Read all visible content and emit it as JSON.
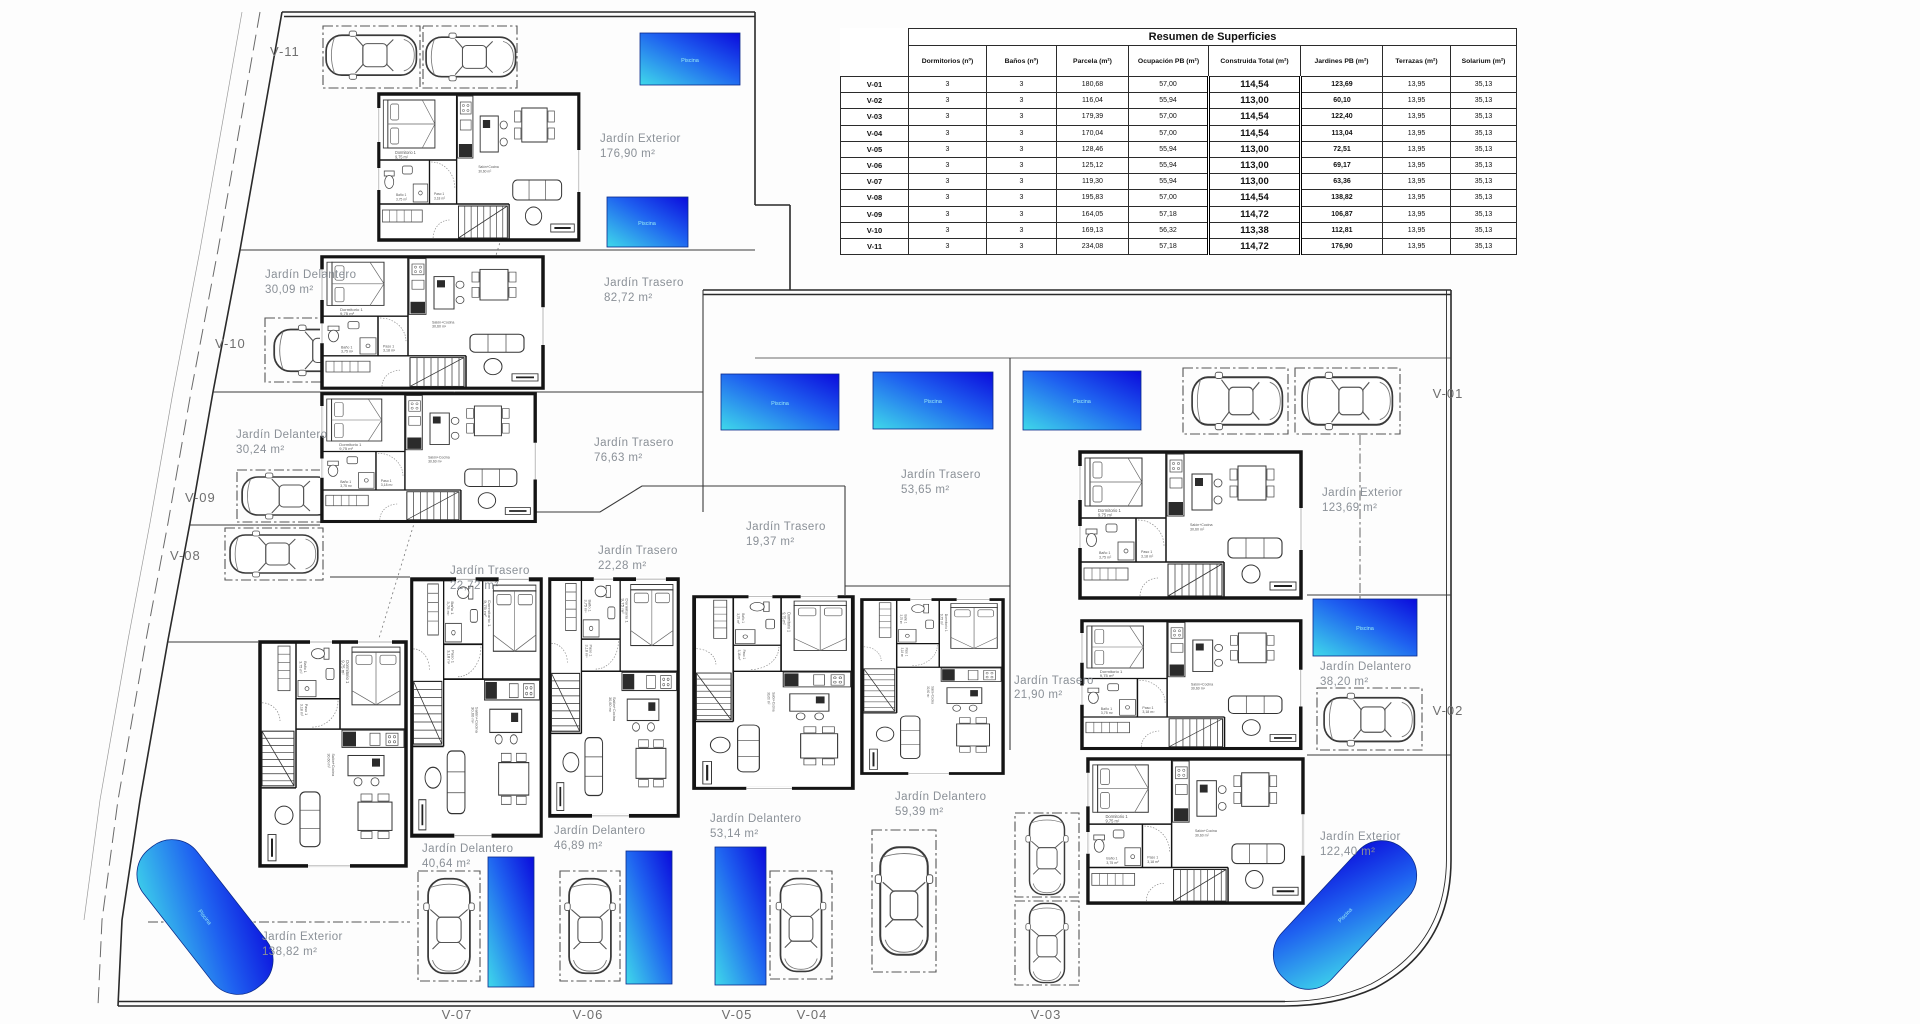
{
  "table": {
    "title": "Resumen de Superficies",
    "columns": [
      "Dormitorios (nº)",
      "Baños (nº)",
      "Parcela (m²)",
      "Ocupación PB (m²)",
      "Construida Total (m²)",
      "Jardines PB (m²)",
      "Terrazas (m²)",
      "Solarium (m²)"
    ],
    "rows": [
      {
        "unit": "V-01",
        "values": [
          "3",
          "3",
          "180,68",
          "57,00",
          "114,54",
          "123,69",
          "13,95",
          "35,13"
        ]
      },
      {
        "unit": "V-02",
        "values": [
          "3",
          "3",
          "116,04",
          "55,94",
          "113,00",
          "60,10",
          "13,95",
          "35,13"
        ]
      },
      {
        "unit": "V-03",
        "values": [
          "3",
          "3",
          "179,39",
          "57,00",
          "114,54",
          "122,40",
          "13,95",
          "35,13"
        ]
      },
      {
        "unit": "V-04",
        "values": [
          "3",
          "3",
          "170,04",
          "57,00",
          "114,54",
          "113,04",
          "13,95",
          "35,13"
        ]
      },
      {
        "unit": "V-05",
        "values": [
          "3",
          "3",
          "128,46",
          "55,94",
          "113,00",
          "72,51",
          "13,95",
          "35,13"
        ]
      },
      {
        "unit": "V-06",
        "values": [
          "3",
          "3",
          "125,12",
          "55,94",
          "113,00",
          "69,17",
          "13,95",
          "35,13"
        ]
      },
      {
        "unit": "V-07",
        "values": [
          "3",
          "3",
          "119,30",
          "55,94",
          "113,00",
          "63,36",
          "13,95",
          "35,13"
        ]
      },
      {
        "unit": "V-08",
        "values": [
          "3",
          "3",
          "195,83",
          "57,00",
          "114,54",
          "138,82",
          "13,95",
          "35,13"
        ]
      },
      {
        "unit": "V-09",
        "values": [
          "3",
          "3",
          "164,05",
          "57,18",
          "114,72",
          "106,87",
          "13,95",
          "35,13"
        ]
      },
      {
        "unit": "V-10",
        "values": [
          "3",
          "3",
          "169,13",
          "56,32",
          "113,38",
          "112,81",
          "13,95",
          "35,13"
        ]
      },
      {
        "unit": "V-11",
        "values": [
          "3",
          "3",
          "234,08",
          "57,18",
          "114,72",
          "176,90",
          "13,95",
          "35,13"
        ]
      }
    ]
  },
  "plan": {
    "unit_labels": [
      "V-01",
      "V-02",
      "V-03",
      "V-04",
      "V-05",
      "V-06",
      "V-07",
      "V-08",
      "V-09",
      "V-10",
      "V-11"
    ],
    "gardens": [
      {
        "name": "Jardín Exterior",
        "area": "176,90 m²"
      },
      {
        "name": "Jardín Delantero",
        "area": "30,09 m²"
      },
      {
        "name": "Jardín Trasero",
        "area": "82,72 m²"
      },
      {
        "name": "Jardín Delantero",
        "area": "30,24 m²"
      },
      {
        "name": "Jardín Trasero",
        "area": "76,63 m²"
      },
      {
        "name": "Jardín Trasero",
        "area": "22,72 m²"
      },
      {
        "name": "Jardín Trasero",
        "area": "22,28 m²"
      },
      {
        "name": "Jardín Trasero",
        "area": "19,37 m²"
      },
      {
        "name": "Jardín Trasero",
        "area": "53,65 m²"
      },
      {
        "name": "Jardín Exterior",
        "area": "123,69 m²"
      },
      {
        "name": "Jardín Delantero",
        "area": "38,20 m²"
      },
      {
        "name": "Jardín Trasero",
        "area": "21,90 m²"
      },
      {
        "name": "Jardín Delantero",
        "area": "40,64 m²"
      },
      {
        "name": "Jardín Delantero",
        "area": "46,89 m²"
      },
      {
        "name": "Jardín Delantero",
        "area": "53,14 m²"
      },
      {
        "name": "Jardín Delantero",
        "area": "59,39 m²"
      },
      {
        "name": "Jardín Exterior",
        "area": "138,82 m²"
      },
      {
        "name": "Jardín Exterior",
        "area": "122,40 m²"
      }
    ],
    "rooms": {
      "bedroom": "Dormitorio 1",
      "bedroom_area": "9,75 m²",
      "bath": "Baño 1",
      "bath_area": "3,75 m²",
      "hall": "Paso 1",
      "hall_area": "3,18 m²",
      "living": "Salón+Cocina",
      "living_area": "30,60 m²"
    },
    "pool_label": "Piscina",
    "colors": {
      "pool_start": "#3fd9ea",
      "pool_end": "#0b0bdc"
    }
  }
}
